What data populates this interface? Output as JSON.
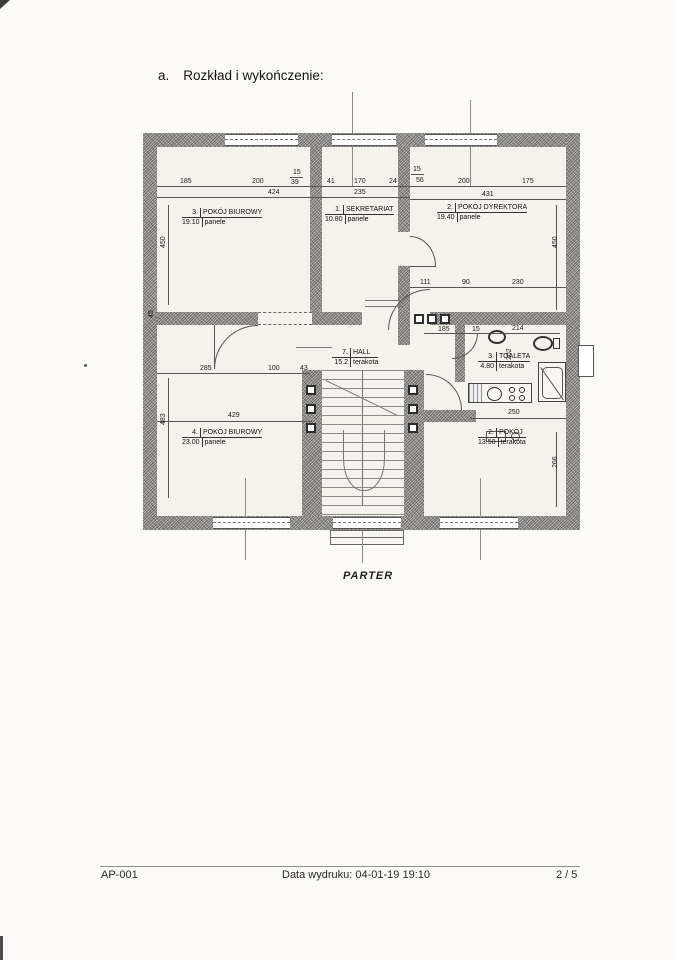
{
  "page": {
    "section_label": "a.",
    "title": "Rozkład i wykończenie:",
    "floor_label": "PARTER"
  },
  "plan": {
    "rooms": [
      {
        "num": "3.",
        "name": "POKÓJ BIUROWY",
        "area": "19.10",
        "finish": "panele"
      },
      {
        "num": "1.",
        "name": "SEKRETARIAT",
        "area": "10.80",
        "finish": "panele"
      },
      {
        "num": "2.",
        "name": "POKÓJ DYREKTORA",
        "area": "19.40",
        "finish": "panele"
      },
      {
        "num": "7.",
        "name": "HALL",
        "area": "15.2",
        "finish": "terakota"
      },
      {
        "num": "3.",
        "name": "TOALETA",
        "area": "4.80",
        "finish": "terakota"
      },
      {
        "num": "4.",
        "name": "POKÓJ BIUROWY",
        "area": "23.00",
        "finish": "panele"
      },
      {
        "num": "2.",
        "name": "POKÓJ",
        "area": "13.50",
        "finish": "terakota"
      }
    ],
    "dims": {
      "r1a": "185",
      "r1b": "200",
      "r1c_top": "15",
      "r1c_bot": "39",
      "r1_total": "424",
      "s1a": "41",
      "s1b": "170",
      "s1c": "24",
      "s1_total": "235",
      "d1a_top": "15",
      "d1a_bot": "56",
      "d1b": "200",
      "d1c": "175",
      "d1_total": "431",
      "left_upper": "450",
      "right_upper": "450",
      "left_mid": "45",
      "left_lower": "483",
      "dir_a": "111",
      "dir_b": "90",
      "dir_c": "230",
      "hall_a": "185",
      "hall_b": "15",
      "hall_c": "214",
      "wc_h": "202",
      "r4a": "285",
      "r4b": "100",
      "r4c": "43",
      "r4_total": "429",
      "r2_total": "250",
      "right_lower": "266"
    }
  },
  "footer": {
    "doc_id": "AP-001",
    "print_info": "Data wydruku: 04-01-19 19:10",
    "page_num": "2 / 5"
  }
}
